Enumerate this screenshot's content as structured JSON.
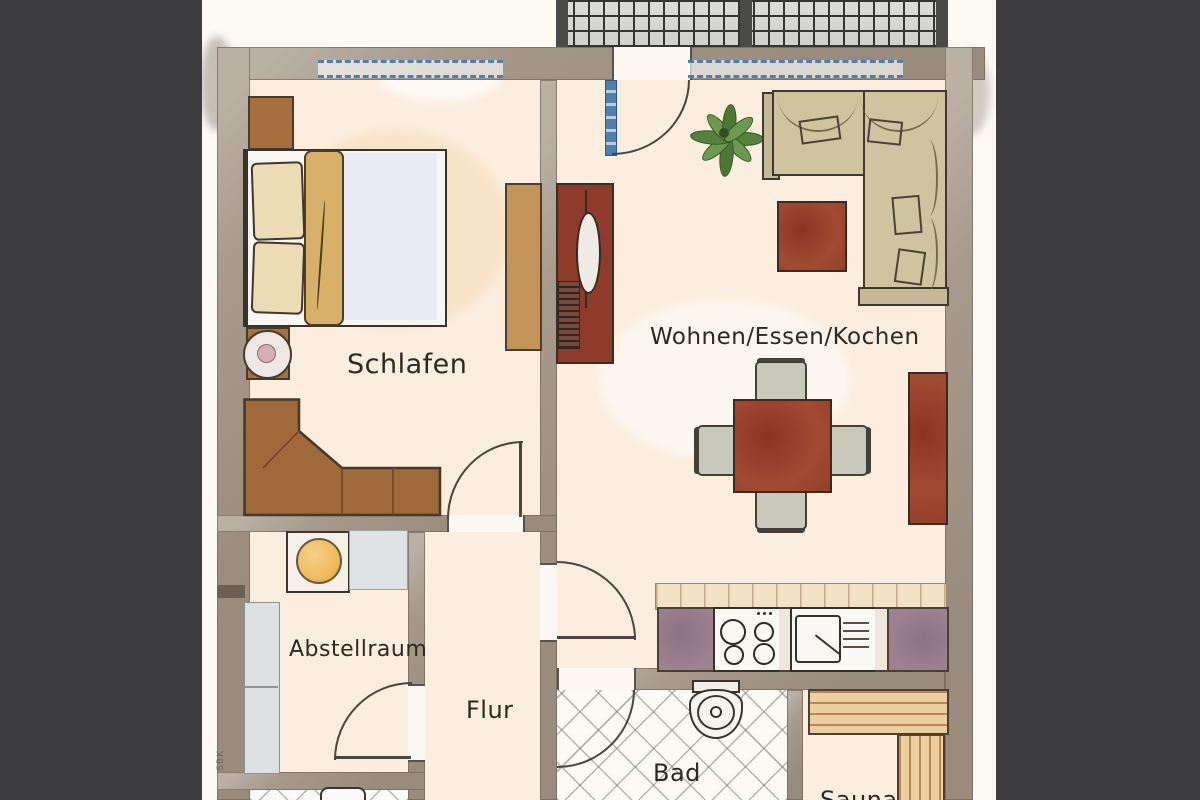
{
  "document": {
    "kind": "hand-drawn apartment floor plan",
    "style": "watercolor sketch"
  },
  "palette": {
    "backdrop": "#3d3d3f",
    "paper": "#fdfaf4",
    "floor_cream": "#fbeede",
    "wall_taupe": "#a79a8b",
    "ink": "#3a352d",
    "window_blue": "#4d80b2",
    "wood_brown": "#a0693a",
    "accent_red": "#9e412e",
    "sofa_tan": "#cfc3a0",
    "counter_mauve": "#9b8290",
    "washer_yellow": "#f0bc5e",
    "plant_green": "#55813f",
    "sauna_wood": "#eccfa0"
  },
  "rooms": {
    "schlafen": {
      "label": "Schlafen"
    },
    "wohnen": {
      "label": "Wohnen/Essen/Kochen"
    },
    "abstellraum": {
      "label": "Abstellraum"
    },
    "flur": {
      "label": "Flur"
    },
    "bad": {
      "label": "Bad"
    },
    "sauna": {
      "label": "Sauna"
    }
  },
  "watermark": "SBK"
}
